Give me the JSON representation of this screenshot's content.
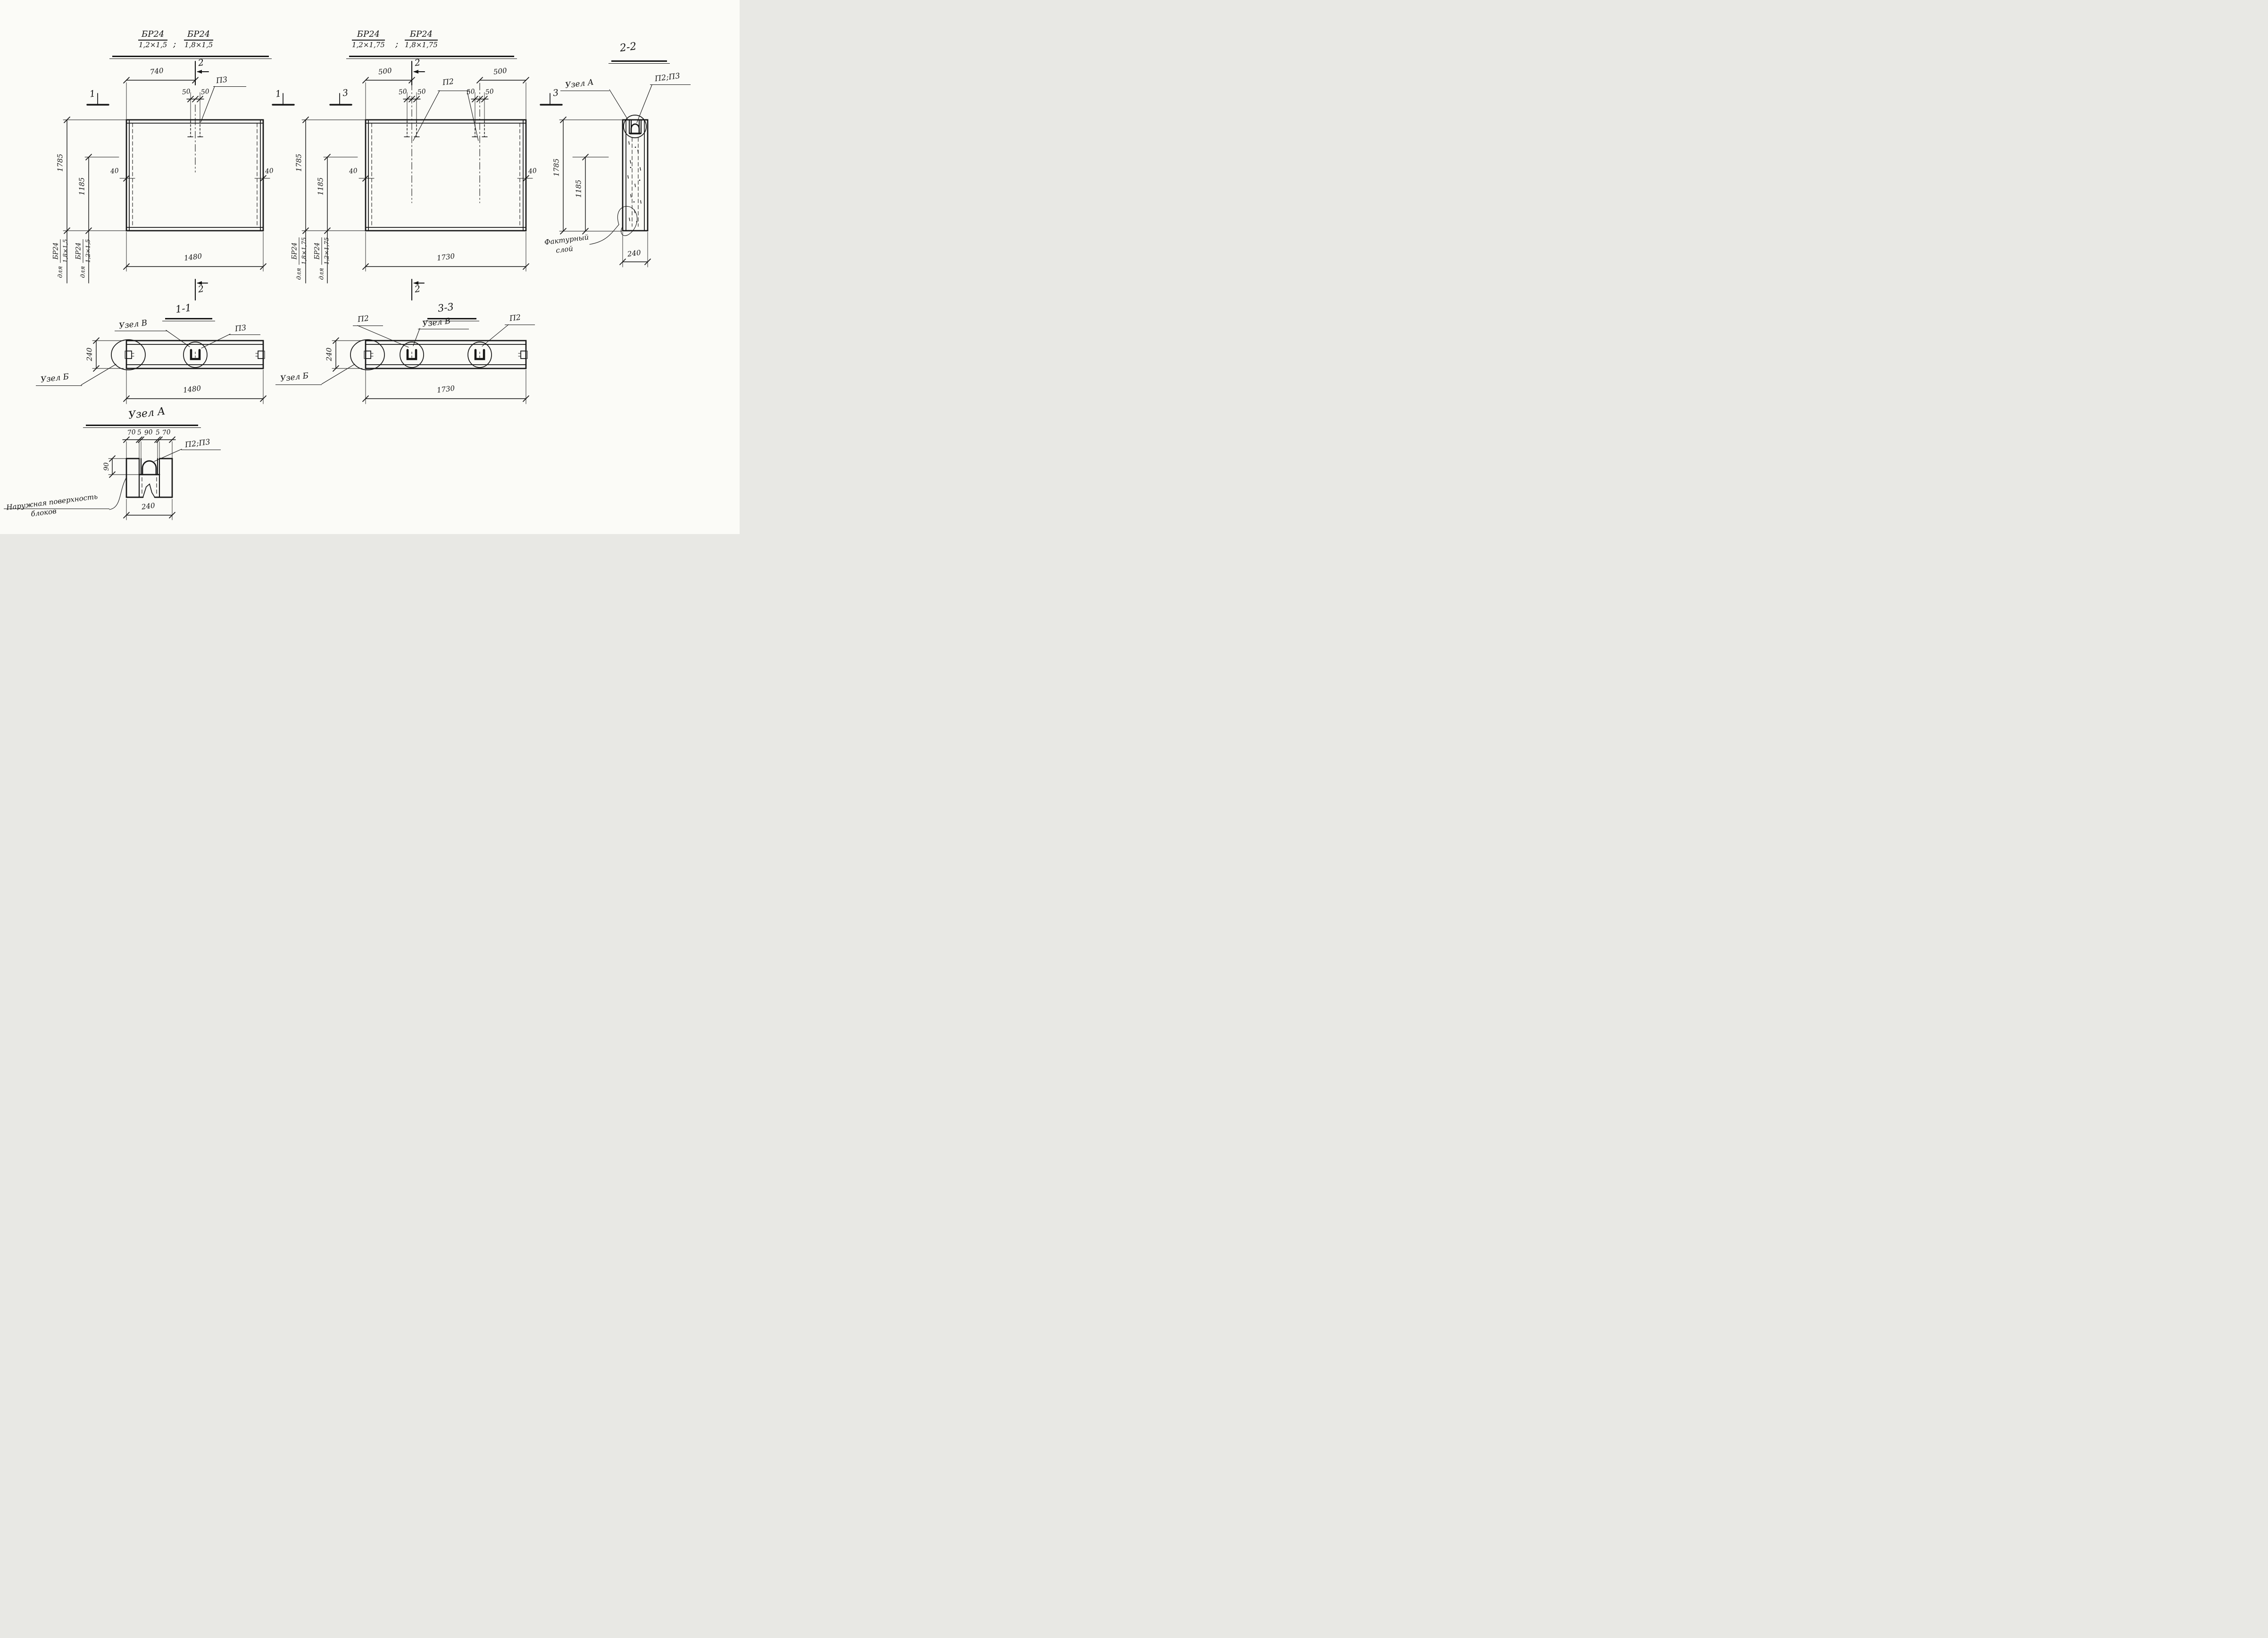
{
  "titles": {
    "view15": {
      "b1num": "БР24",
      "b1den": "1,2×1,5",
      "sep": ";",
      "b2num": "БР24",
      "b2den": "1,8×1,5"
    },
    "view175": {
      "b1num": "БР24",
      "b1den": "1,2×1,75",
      "sep": ";",
      "b2num": "БР24",
      "b2den": "1,8×1,75"
    },
    "s22": "2-2",
    "s11": "1-1",
    "s33": "3-3",
    "uzelA": "Узел А"
  },
  "markers": {
    "m1": "1",
    "m2": "2",
    "m3": "3"
  },
  "p15": {
    "d740": "740",
    "d50": "50",
    "p3": "П3",
    "d1785": "1785",
    "d1185": "1185",
    "d40": "40",
    "d1480": "1480",
    "for18": {
      "prefix": "для",
      "num": "БР24",
      "den": "1,8×1,5"
    },
    "for12": {
      "prefix": "для",
      "num": "БР24",
      "den": "1,2×1,5"
    }
  },
  "p175": {
    "d500": "500",
    "d50": "50",
    "p2": "П2",
    "d1785": "1785",
    "d1185": "1185",
    "d40": "40",
    "d1730": "1730",
    "for18": {
      "prefix": "для",
      "num": "БР24",
      "den": "1,8×1,75"
    },
    "for12": {
      "prefix": "для",
      "num": "БР24",
      "den": "1,2×1,75"
    }
  },
  "s11": {
    "uzelV": "Узел В",
    "p3": "П3",
    "d240": "240",
    "uzelB": "Узел Б",
    "d1480": "1480"
  },
  "s33": {
    "p2l": "П2",
    "uzelV": "Узел В",
    "p2r": "П2",
    "d240": "240",
    "uzelB": "Узел Б",
    "d1730": "1730"
  },
  "s22": {
    "uzelA": "Узел А",
    "p2p3": "П2;П3",
    "d1785": "1785",
    "d1185": "1185",
    "d240": "240",
    "factur1": "Фактурный",
    "factur2": "слой"
  },
  "uzA": {
    "t70": "70",
    "t5": "5",
    "t90": "90",
    "p2p3": "П2;П3",
    "d90": "90",
    "d240": "240",
    "surf1": "Наружная поверхность",
    "surf2": "блоков"
  }
}
